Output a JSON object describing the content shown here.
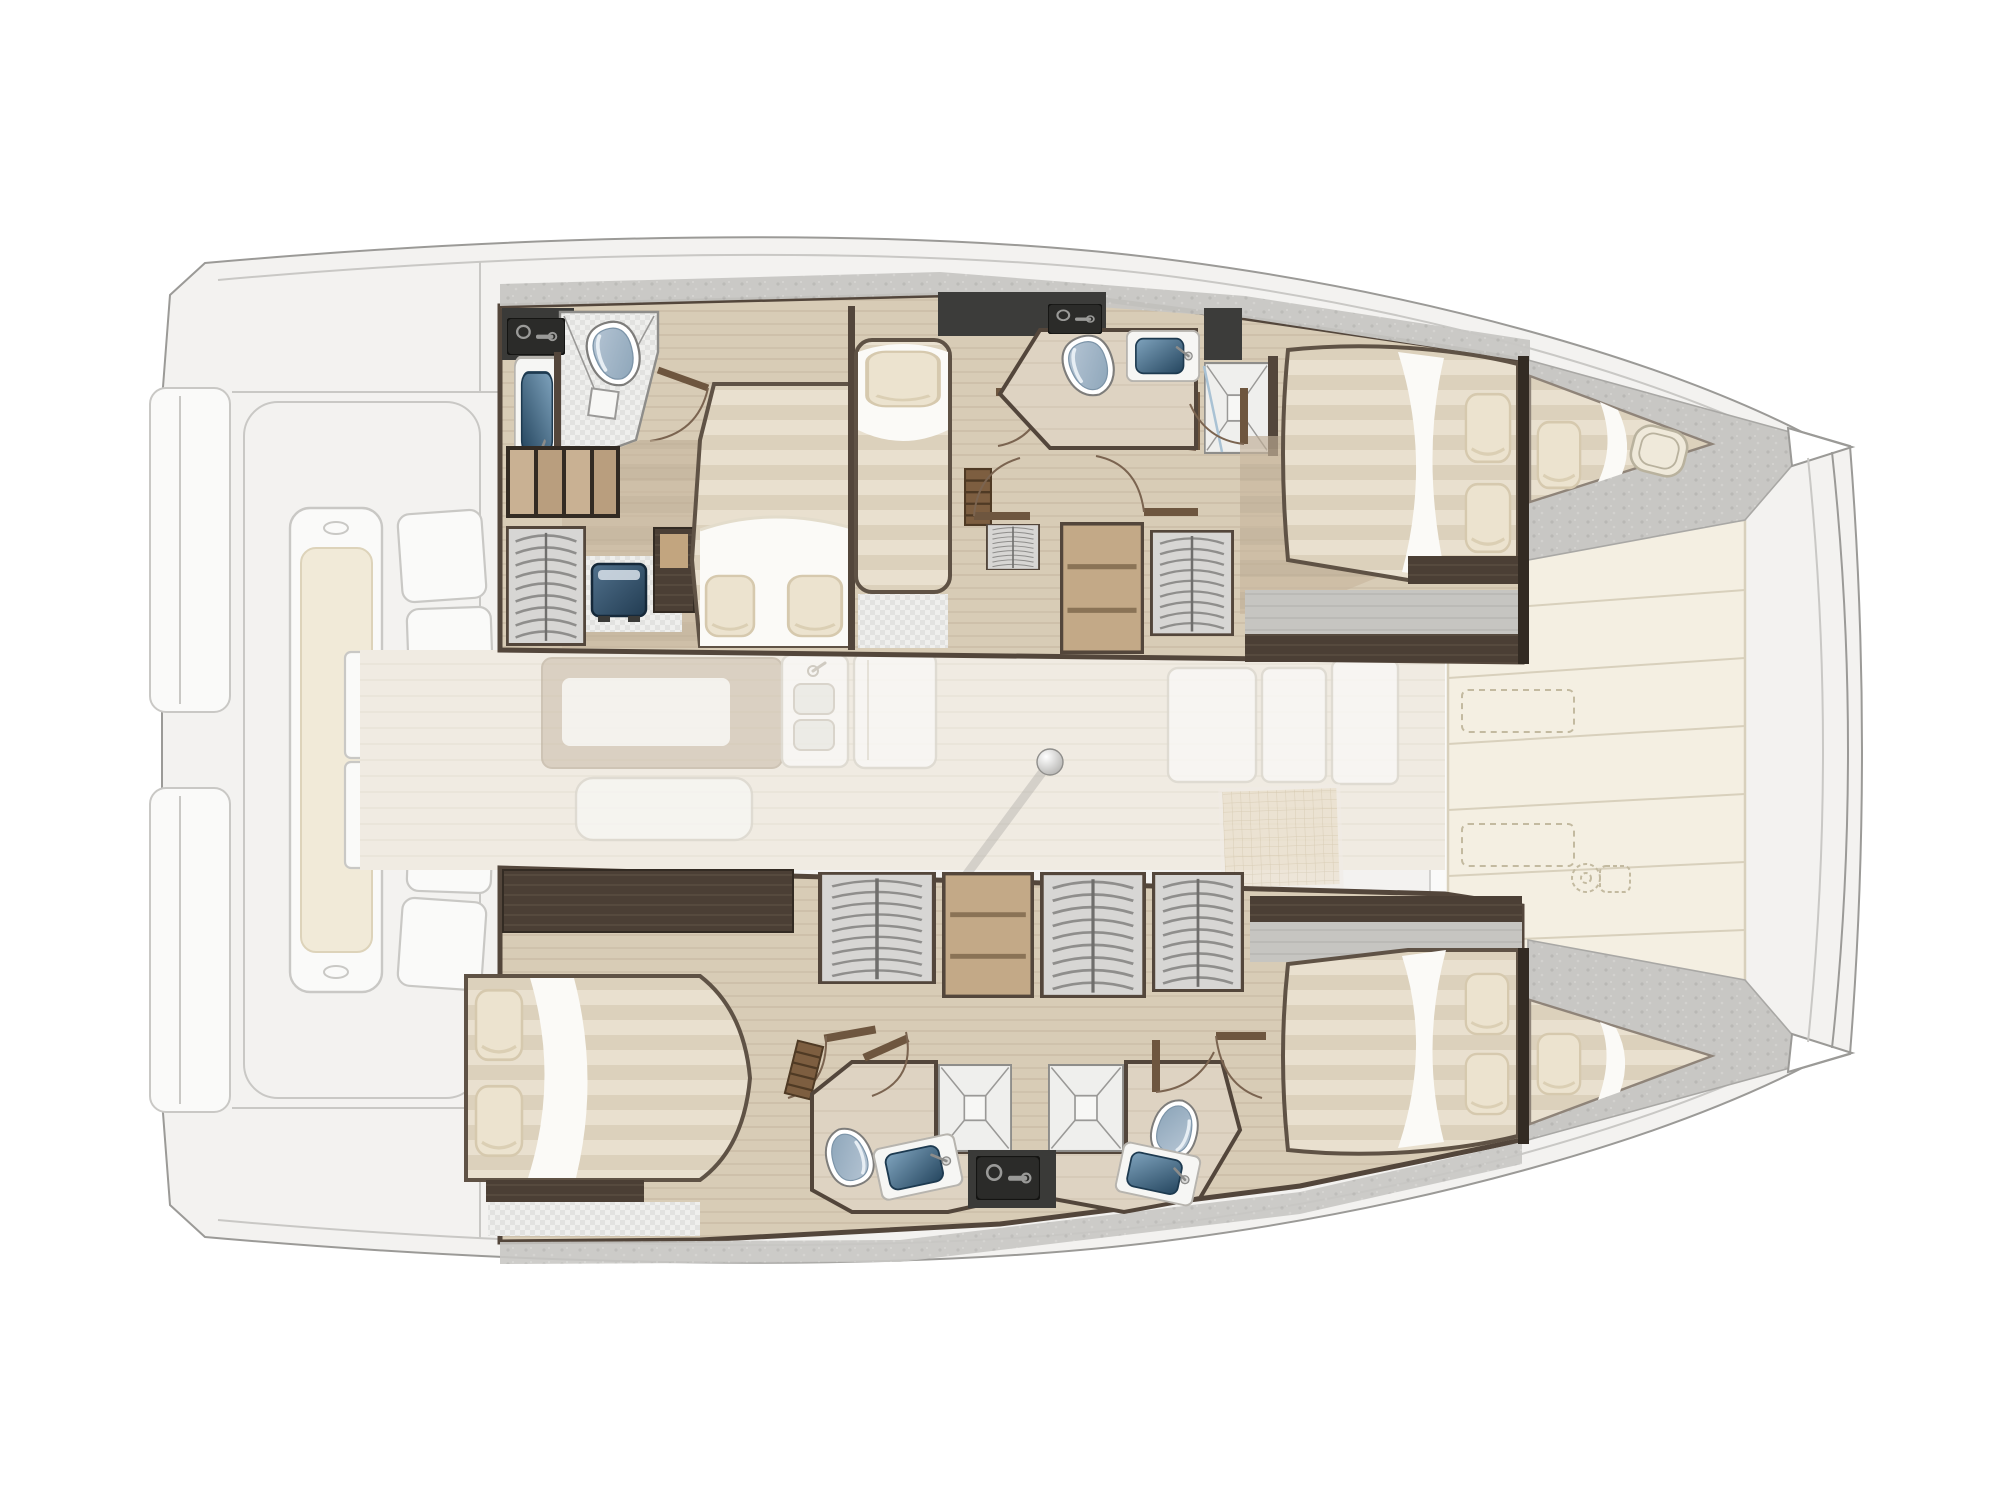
{
  "meta": {
    "diagram_type": "yacht-floor-plan",
    "subject": "catamaran-interior-layout-top-view",
    "orientation": "bow-right-stern-left",
    "style": "rendered architectural plan, exterior decks ghosted, interiors in color"
  },
  "visible_elements": {
    "double_beds": 4,
    "single_berths": 1,
    "bow_peak_berths": 2,
    "toilets": 4,
    "washbasins": 4,
    "showers": 4,
    "wardrobe_hanging_lockers": 7,
    "drawer_units": 3,
    "companionway_steps": 2,
    "door_swings": 11,
    "mast_post": 1,
    "ghosted_salon_table": 1,
    "ghosted_galley_blocks": 4,
    "ghosted_aft_bench": 1,
    "foredeck_sunpad_panels": 8,
    "transom_platforms": 2
  },
  "palette": {
    "ghost-fill": "#f3f2f0",
    "ghost-line": "#c9c8c5",
    "ghost-inner": "#fafaf9",
    "ghost-cushion": "#f1ead8",
    "ghost-cushion-line": "#ddd3ba",
    "salon-floor": "#f0ebe2",
    "salon-line": "#e5dfd2",
    "pad-fill": "#f4efe2",
    "pad-line": "#d8d0bc",
    "pad-stitch": "#c3baa0",
    "deck-gray": "#c8c7c4",
    "deck-speck": "#b9b8b5",
    "wood-cabin": "#c8b69e",
    "wood-cabin-band": "#bdac94",
    "wood-corr": "#d8ccb6",
    "wood-corr-line": "#ccbfa8",
    "wood-pale": "#ded3c2",
    "wood-pale-line": "#d2c6b2",
    "wood-dark": "#4b3f35",
    "wood-dark-grain": "#5d5043",
    "wood-step": "#7d5e40",
    "wood-drawer": "#c3a987",
    "wood-drawer-line": "#8a7356",
    "wall": "#53463b",
    "wall-deep": "#332b23",
    "charcoal": "#3c3c3a",
    "black-unit": "#2b2b29",
    "tile": "#efefed",
    "tile-dot": "#e2e2e0",
    "bed-base": "#e9e0cf",
    "bed-band": "#dcd1bc",
    "bed-frame": "#5f5245",
    "sheet": "#fbfaf7",
    "pillow": "#ece3cf",
    "pillow-line": "#d6c9ae",
    "basin-deep": "#24455e",
    "basin-light": "#7fa3bd",
    "porcelain": "#ffffff",
    "seat-blue": "#b7c6d5",
    "seat-blue-deep": "#8ba4b8",
    "fixture-line": "#7e7d7b",
    "glyph-gray": "#9a9a98",
    "door": "#7b6450",
    "door-leaf": "#6e563f",
    "shadow": "#8e8d8b",
    "hatch": "#efe9da",
    "hatch-line": "#b9b29e",
    "gray-wood": "#c6c5c1",
    "gray-wood-line": "#b5b4b0",
    "locker-bg": "#d7d6d4",
    "locker-rib": "#8f8e8c",
    "tv-deep": "#223c52",
    "tv-light": "#51718c",
    "outline": "#9b9a97",
    "grid-ghost": "#c9b896",
    "grid-bg": "#e8dcc6"
  },
  "legend": {
    "ghosted_areas": "exterior decks, cockpit, salon furniture (semi-transparent)",
    "solid_areas": "lower-hull accommodations",
    "port_hull_top": [
      "aft-head-with-wetroom",
      "owner-double-cabin",
      "single-berth",
      "mid-head-with-shower",
      "dressing-wardrobes",
      "forward-double-cabin",
      "bow-peak-berth"
    ],
    "starboard_hull_bottom": [
      "aft-double-cabin",
      "wardrobe-row",
      "back-to-back-heads-with-showers",
      "forward-double-cabin",
      "bow-peak-berth"
    ],
    "center": [
      "aft-cockpit-bench",
      "salon-table-ghost",
      "galley-ghost",
      "mast-post",
      "foredeck-sunpads"
    ]
  }
}
